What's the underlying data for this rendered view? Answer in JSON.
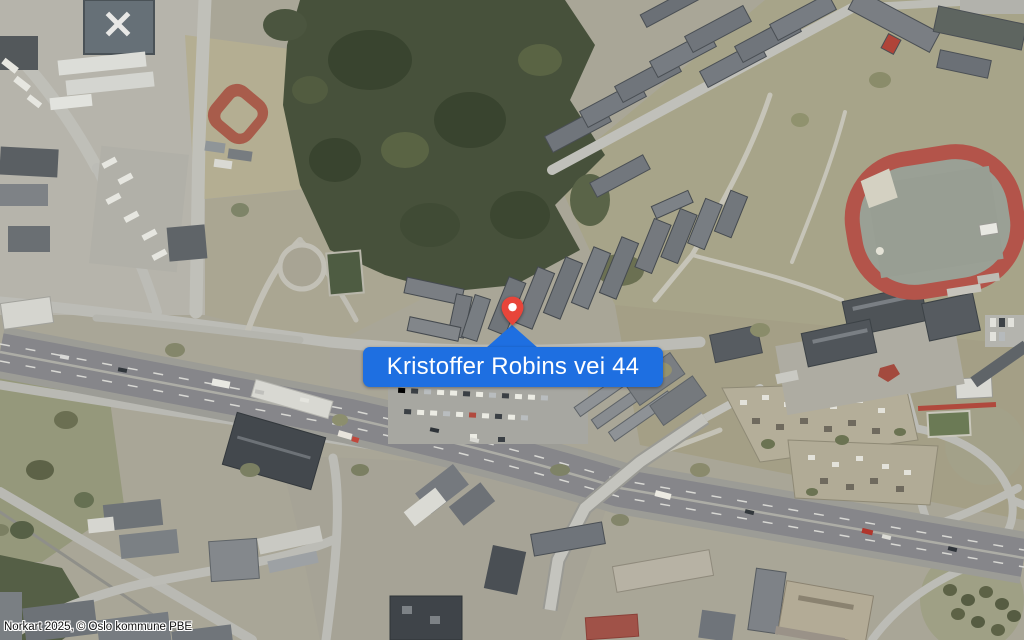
{
  "map": {
    "type": "aerial-photo",
    "callout": {
      "label": "Kristoffer Robins vei 44"
    },
    "attribution": "Norkart 2025, © Oslo kommune PBE",
    "colors": {
      "callout_blue": "#1e6fe1",
      "callout_text": "#ffffff",
      "pin_red": "#e8453a",
      "pin_dot": "#ffffff",
      "attribution_text": "#0e0e0e",
      "track_red": "#b3544a",
      "forest_green": "#47513b"
    }
  }
}
